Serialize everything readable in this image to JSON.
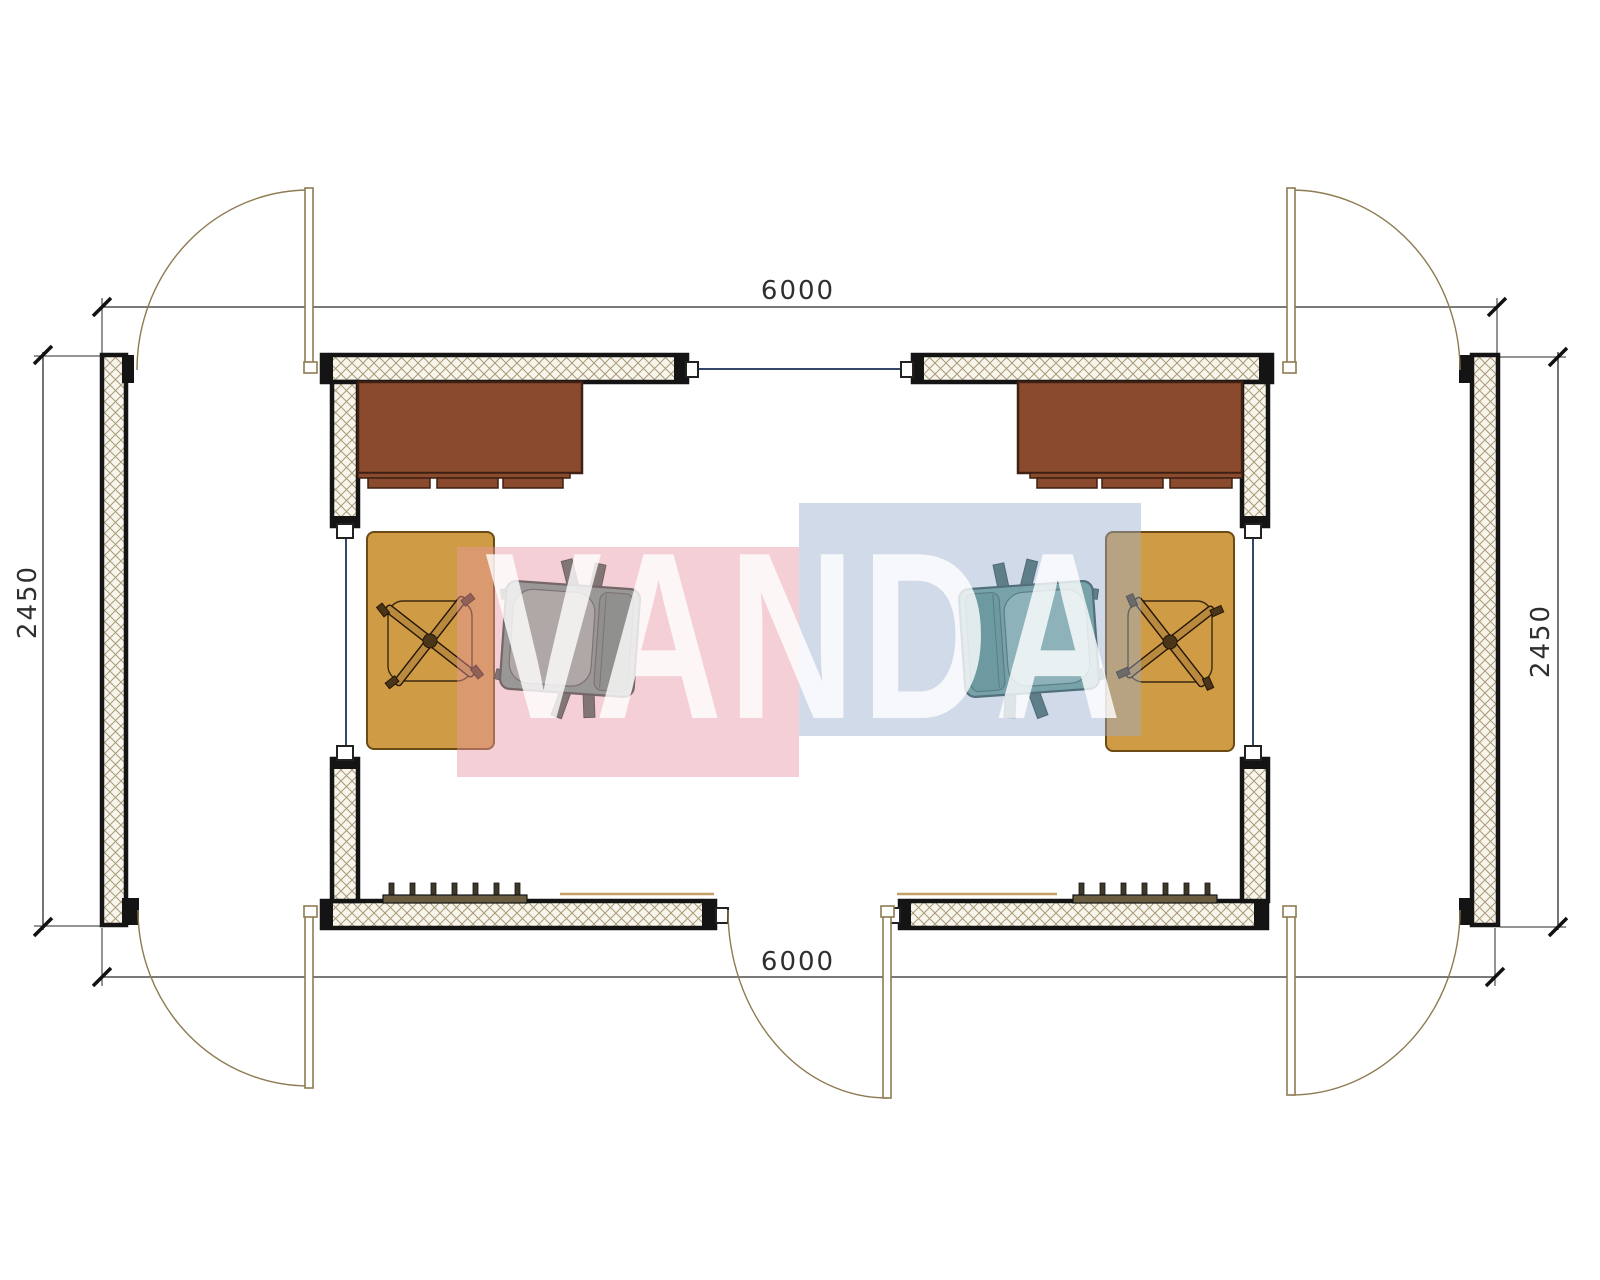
{
  "meta": {
    "width": 1600,
    "height": 1280,
    "background": "#ffffff"
  },
  "dimensions": {
    "top": "6000",
    "bottom": "6000",
    "left": "2450",
    "right": "2450"
  },
  "watermark": {
    "text": "VANDA",
    "pink": "#e796a5",
    "blue": "#98aecf",
    "letter": "#ffffff"
  },
  "colors": {
    "wall_outline": "#141414",
    "hatch_bg": "#f8f5ec",
    "hatch_line": "#a89a78",
    "dim_line": "#2a2a2a",
    "dim_text": "#2f2f2f",
    "door": "#8d7b52",
    "window_line": "#35466b",
    "sill": "#c59f68",
    "radiator": "#6a5c40",
    "desk": "#8a4a2e",
    "desk_outline": "#3f2012",
    "table": "#cf9b44",
    "table_outline": "#6b4a14",
    "chair_base": "#b98a3e",
    "armchair_body": "#5b9a8c",
    "armchair_cushion": "#84b7a9",
    "armchair_back": "#4a8a7c",
    "armchair_outline": "#183f37",
    "wm_pink": "#e796a5",
    "wm_blue": "#98aecf",
    "wm_letter": "#ffffff"
  }
}
